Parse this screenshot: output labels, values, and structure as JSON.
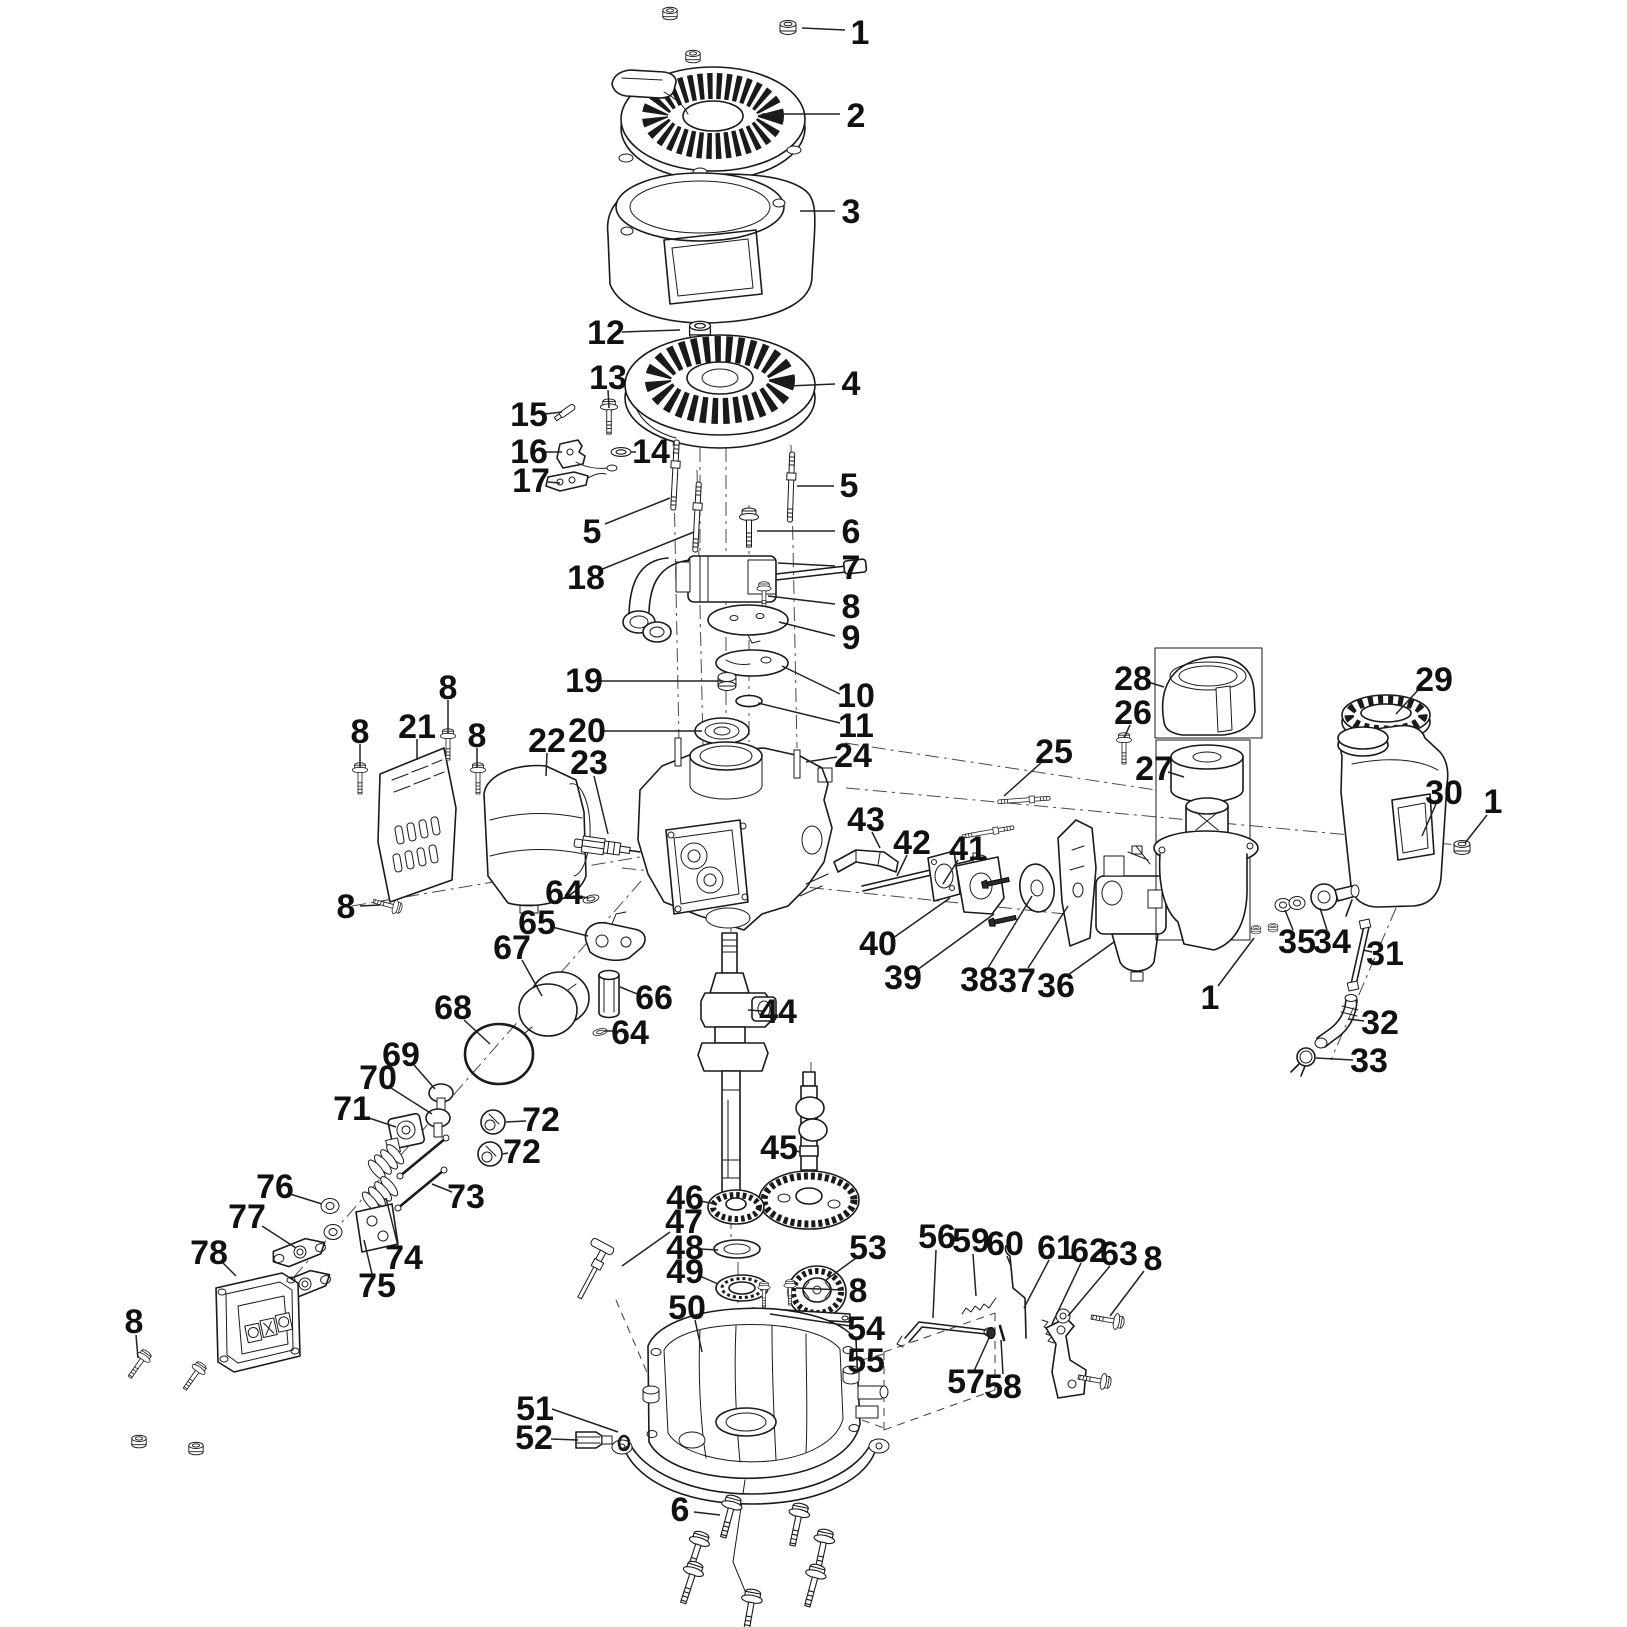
{
  "diagram": {
    "colors": {
      "background": "#ffffff",
      "line": "#1a1a1a",
      "label": "#111111"
    },
    "callouts": [
      {
        "n": "1",
        "x": 860,
        "y": 33,
        "l": [
          845,
          30,
          802,
          28
        ]
      },
      {
        "n": "2",
        "x": 856,
        "y": 116,
        "l": [
          840,
          114,
          762,
          114
        ]
      },
      {
        "n": "3",
        "x": 851,
        "y": 212,
        "l": [
          835,
          211,
          800,
          211
        ]
      },
      {
        "n": "12",
        "x": 606,
        "y": 333,
        "l": [
          622,
          332,
          680,
          330
        ]
      },
      {
        "n": "13",
        "x": 608,
        "y": 378,
        "l": [
          608,
          390,
          609,
          408
        ]
      },
      {
        "n": "4",
        "x": 851,
        "y": 384,
        "l": [
          835,
          384,
          788,
          386
        ]
      },
      {
        "n": "15",
        "x": 529,
        "y": 415,
        "l": [
          545,
          414,
          562,
          412
        ]
      },
      {
        "n": "16",
        "x": 529,
        "y": 452,
        "l": [
          546,
          452,
          562,
          452
        ]
      },
      {
        "n": "14",
        "x": 651,
        "y": 452,
        "l": [
          636,
          452,
          631,
          452
        ]
      },
      {
        "n": "17",
        "x": 531,
        "y": 481,
        "l": [
          548,
          482,
          560,
          483
        ]
      },
      {
        "n": "5",
        "x": 849,
        "y": 486,
        "l": [
          834,
          486,
          797,
          486
        ]
      },
      {
        "n": "5",
        "x": 592,
        "y": 532,
        "l": [
          605,
          524,
          670,
          498
        ]
      },
      {
        "n": "6",
        "x": 851,
        "y": 532,
        "l": [
          835,
          531,
          757,
          531
        ]
      },
      {
        "n": "18",
        "x": 586,
        "y": 578,
        "l": [
          600,
          570,
          694,
          532
        ]
      },
      {
        "n": "7",
        "x": 851,
        "y": 568,
        "l": [
          835,
          566,
          778,
          563
        ]
      },
      {
        "n": "8",
        "x": 851,
        "y": 607,
        "l": [
          835,
          604,
          768,
          596
        ]
      },
      {
        "n": "9",
        "x": 851,
        "y": 638,
        "l": [
          835,
          636,
          779,
          622
        ]
      },
      {
        "n": "19",
        "x": 584,
        "y": 681,
        "l": [
          600,
          681,
          722,
          681
        ]
      },
      {
        "n": "10",
        "x": 856,
        "y": 696,
        "l": [
          840,
          694,
          782,
          666
        ]
      },
      {
        "n": "20",
        "x": 587,
        "y": 731,
        "l": [
          603,
          731,
          702,
          731
        ]
      },
      {
        "n": "11",
        "x": 856,
        "y": 726,
        "l": [
          840,
          723,
          758,
          703
        ]
      },
      {
        "n": "24",
        "x": 853,
        "y": 756,
        "l": [
          837,
          757,
          806,
          762
        ]
      },
      {
        "n": "22",
        "x": 547,
        "y": 741,
        "l": [
          547,
          753,
          546,
          776
        ]
      },
      {
        "n": "23",
        "x": 589,
        "y": 763,
        "l": [
          594,
          776,
          608,
          834
        ]
      },
      {
        "n": "43",
        "x": 866,
        "y": 820,
        "l": [
          872,
          832,
          880,
          848
        ]
      },
      {
        "n": "8",
        "x": 448,
        "y": 688,
        "l": [
          448,
          700,
          448,
          734
        ]
      },
      {
        "n": "21",
        "x": 417,
        "y": 727,
        "l": [
          417,
          739,
          417,
          760
        ]
      },
      {
        "n": "8",
        "x": 360,
        "y": 732,
        "l": [
          360,
          744,
          360,
          768
        ]
      },
      {
        "n": "8",
        "x": 477,
        "y": 736,
        "l": [
          477,
          748,
          477,
          768
        ]
      },
      {
        "n": "8",
        "x": 346,
        "y": 907,
        "l": [
          360,
          906,
          380,
          905
        ]
      },
      {
        "n": "25",
        "x": 1054,
        "y": 752,
        "l": [
          1042,
          762,
          1004,
          796
        ]
      },
      {
        "n": "26",
        "x": 1133,
        "y": 713,
        "l": [
          1130,
          725,
          1124,
          738
        ]
      },
      {
        "n": "28",
        "x": 1133,
        "y": 679,
        "l": [
          1148,
          682,
          1164,
          687
        ]
      },
      {
        "n": "27",
        "x": 1154,
        "y": 769,
        "l": [
          1168,
          772,
          1184,
          777
        ]
      },
      {
        "n": "29",
        "x": 1434,
        "y": 680,
        "l": [
          1420,
          688,
          1396,
          714
        ]
      },
      {
        "n": "30",
        "x": 1444,
        "y": 793,
        "l": [
          1436,
          804,
          1422,
          836
        ]
      },
      {
        "n": "1",
        "x": 1493,
        "y": 802,
        "l": [
          1487,
          815,
          1465,
          843
        ]
      },
      {
        "n": "42",
        "x": 912,
        "y": 843,
        "l": [
          907,
          855,
          897,
          876
        ]
      },
      {
        "n": "41",
        "x": 968,
        "y": 849,
        "l": [
          958,
          860,
          943,
          884
        ]
      },
      {
        "n": "40",
        "x": 878,
        "y": 944,
        "l": [
          893,
          938,
          950,
          898
        ]
      },
      {
        "n": "39",
        "x": 903,
        "y": 978,
        "l": [
          917,
          970,
          994,
          914
        ]
      },
      {
        "n": "38",
        "x": 979,
        "y": 980,
        "l": [
          988,
          968,
          1032,
          896
        ]
      },
      {
        "n": "37",
        "x": 1017,
        "y": 981,
        "l": [
          1028,
          968,
          1068,
          906
        ]
      },
      {
        "n": "36",
        "x": 1056,
        "y": 986,
        "l": [
          1068,
          975,
          1114,
          942
        ]
      },
      {
        "n": "35",
        "x": 1297,
        "y": 942,
        "l": [
          1293,
          930,
          1285,
          910
        ]
      },
      {
        "n": "34",
        "x": 1332,
        "y": 942,
        "l": [
          1327,
          930,
          1320,
          908
        ]
      },
      {
        "n": "31",
        "x": 1385,
        "y": 954,
        "l": [
          1372,
          952,
          1363,
          950
        ]
      },
      {
        "n": "32",
        "x": 1380,
        "y": 1023,
        "l": [
          1364,
          1021,
          1348,
          1019
        ]
      },
      {
        "n": "33",
        "x": 1369,
        "y": 1061,
        "l": [
          1353,
          1060,
          1316,
          1058
        ]
      },
      {
        "n": "1",
        "x": 1210,
        "y": 998,
        "l": [
          1218,
          986,
          1254,
          938
        ]
      },
      {
        "n": "64",
        "x": 564,
        "y": 893,
        "l": [
          578,
          896,
          588,
          898
        ]
      },
      {
        "n": "65",
        "x": 537,
        "y": 923,
        "l": [
          552,
          927,
          588,
          936
        ]
      },
      {
        "n": "67",
        "x": 512,
        "y": 948,
        "l": [
          522,
          960,
          542,
          996
        ]
      },
      {
        "n": "68",
        "x": 453,
        "y": 1008,
        "l": [
          464,
          1020,
          490,
          1044
        ]
      },
      {
        "n": "66",
        "x": 654,
        "y": 998,
        "l": [
          640,
          995,
          620,
          987
        ]
      },
      {
        "n": "64",
        "x": 630,
        "y": 1033,
        "l": [
          616,
          1031,
          604,
          1031
        ]
      },
      {
        "n": "44",
        "x": 778,
        "y": 1012,
        "l": [
          762,
          1011,
          748,
          1010
        ]
      },
      {
        "n": "69",
        "x": 401,
        "y": 1055,
        "l": [
          414,
          1065,
          435,
          1089
        ]
      },
      {
        "n": "70",
        "x": 378,
        "y": 1078,
        "l": [
          391,
          1088,
          432,
          1114
        ]
      },
      {
        "n": "71",
        "x": 352,
        "y": 1109,
        "l": [
          366,
          1117,
          396,
          1127
        ]
      },
      {
        "n": "72",
        "x": 541,
        "y": 1120,
        "l": [
          526,
          1121,
          506,
          1122
        ]
      },
      {
        "n": "72",
        "x": 522,
        "y": 1152,
        "l": [
          508,
          1153,
          503,
          1154
        ]
      },
      {
        "n": "73",
        "x": 466,
        "y": 1197,
        "l": [
          452,
          1192,
          432,
          1184
        ]
      },
      {
        "n": "76",
        "x": 275,
        "y": 1187,
        "l": [
          290,
          1194,
          322,
          1204
        ]
      },
      {
        "n": "77",
        "x": 247,
        "y": 1217,
        "l": [
          262,
          1226,
          296,
          1248
        ]
      },
      {
        "n": "74",
        "x": 404,
        "y": 1258,
        "l": [
          398,
          1246,
          386,
          1198
        ]
      },
      {
        "n": "75",
        "x": 377,
        "y": 1286,
        "l": [
          372,
          1274,
          364,
          1240
        ]
      },
      {
        "n": "78",
        "x": 209,
        "y": 1253,
        "l": [
          222,
          1262,
          236,
          1276
        ]
      },
      {
        "n": "8",
        "x": 134,
        "y": 1322,
        "l": [
          136,
          1335,
          138,
          1358
        ]
      },
      {
        "n": "45",
        "x": 779,
        "y": 1148,
        "l": [
          793,
          1150,
          800,
          1152
        ]
      },
      {
        "n": "46",
        "x": 685,
        "y": 1198,
        "l": [
          700,
          1201,
          716,
          1204
        ]
      },
      {
        "n": "47",
        "x": 684,
        "y": 1222,
        "l": [
          670,
          1232,
          622,
          1266
        ]
      },
      {
        "n": "48",
        "x": 685,
        "y": 1248,
        "l": [
          700,
          1249,
          718,
          1250
        ]
      },
      {
        "n": "49",
        "x": 685,
        "y": 1272,
        "l": [
          700,
          1276,
          718,
          1284
        ]
      },
      {
        "n": "53",
        "x": 868,
        "y": 1248,
        "l": [
          856,
          1258,
          826,
          1280
        ]
      },
      {
        "n": "8",
        "x": 858,
        "y": 1291,
        "l": [
          843,
          1290,
          796,
          1288
        ]
      },
      {
        "n": "50",
        "x": 687,
        "y": 1308,
        "l": [
          695,
          1320,
          702,
          1352
        ]
      },
      {
        "n": "54",
        "x": 866,
        "y": 1329,
        "l": [
          850,
          1326,
          770,
          1314
        ]
      },
      {
        "n": "55",
        "x": 866,
        "y": 1361,
        "l": [
          858,
          1370,
          852,
          1374
        ]
      },
      {
        "n": "51",
        "x": 535,
        "y": 1409,
        "l": [
          552,
          1409,
          618,
          1432
        ]
      },
      {
        "n": "52",
        "x": 534,
        "y": 1438,
        "l": [
          551,
          1439,
          578,
          1440
        ]
      },
      {
        "n": "6",
        "x": 680,
        "y": 1510,
        "l": [
          694,
          1512,
          720,
          1515
        ]
      },
      {
        "n": "56",
        "x": 937,
        "y": 1237,
        "l": [
          936,
          1250,
          933,
          1318
        ]
      },
      {
        "n": "59",
        "x": 971,
        "y": 1241,
        "l": [
          973,
          1254,
          976,
          1296
        ]
      },
      {
        "n": "60",
        "x": 1005,
        "y": 1244,
        "l": [
          1007,
          1256,
          1011,
          1266
        ]
      },
      {
        "n": "61",
        "x": 1056,
        "y": 1248,
        "l": [
          1049,
          1260,
          1024,
          1308
        ]
      },
      {
        "n": "62",
        "x": 1089,
        "y": 1251,
        "l": [
          1081,
          1263,
          1052,
          1324
        ]
      },
      {
        "n": "63",
        "x": 1119,
        "y": 1254,
        "l": [
          1110,
          1266,
          1068,
          1316
        ]
      },
      {
        "n": "8",
        "x": 1153,
        "y": 1259,
        "l": [
          1144,
          1271,
          1110,
          1316
        ]
      },
      {
        "n": "57",
        "x": 966,
        "y": 1382,
        "l": [
          974,
          1371,
          989,
          1338
        ]
      },
      {
        "n": "58",
        "x": 1003,
        "y": 1387,
        "l": [
          1003,
          1374,
          1001,
          1340
        ]
      }
    ]
  }
}
